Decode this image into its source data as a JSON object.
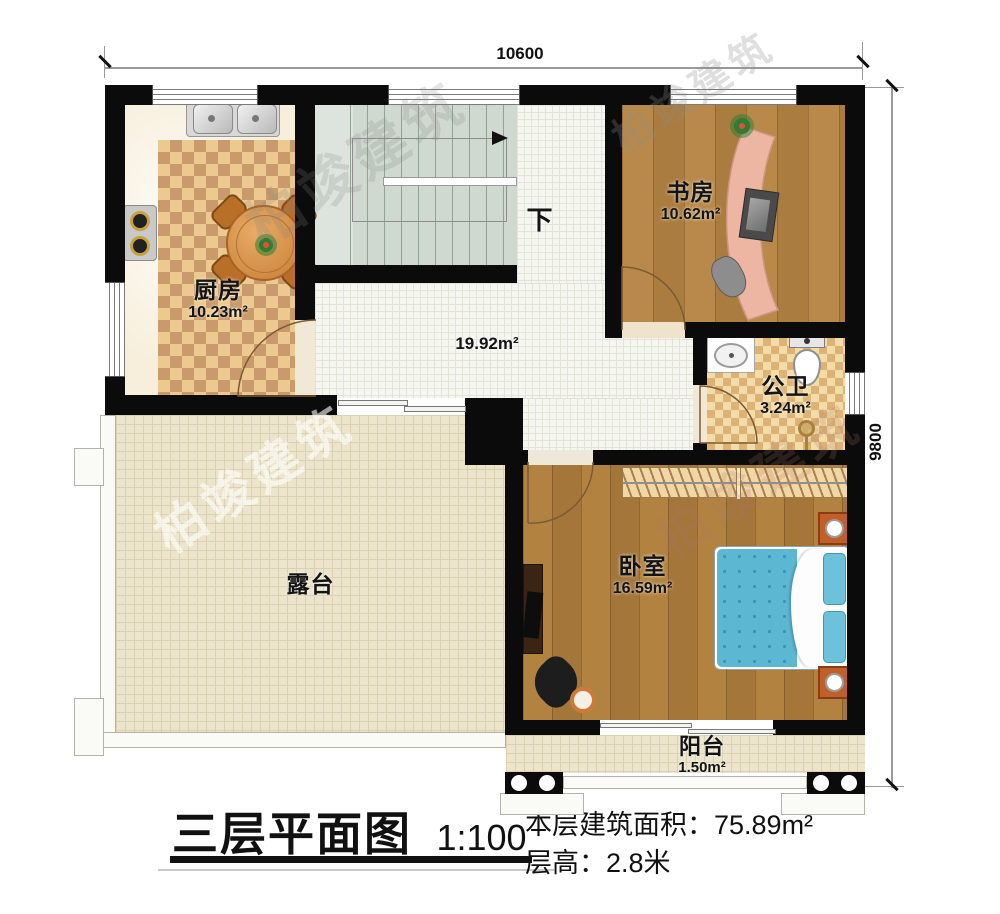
{
  "dimensions": {
    "top": "10600",
    "right": "9800"
  },
  "rooms": {
    "kitchen": {
      "name": "厨房",
      "area": "10.23m²"
    },
    "study": {
      "name": "书房",
      "area": "10.62m²"
    },
    "bathroom": {
      "name": "公卫",
      "area": "3.24m²"
    },
    "bedroom": {
      "name": "卧室",
      "area": "16.59m²"
    },
    "hallway": {
      "area": "19.92m²"
    },
    "terrace": {
      "name": "露台"
    },
    "balcony": {
      "name": "阳台",
      "area": "1.50m²"
    }
  },
  "stairs": {
    "down": "下"
  },
  "title_block": {
    "title": "三层平面图",
    "scale": "1:100",
    "area_label": "本层建筑面积：",
    "area_value": "75.89m²",
    "height_label": "层高：",
    "height_value": "2.8米"
  },
  "watermark": {
    "text": "柏竣建筑"
  },
  "colors": {
    "wall": "#0b0b0b",
    "wood_floor": "#b5873f",
    "bed_blue": "#5bb7d2",
    "checker_dark": "#c89a6c",
    "checker_light": "#ecc98e",
    "outdoor_tile": "#ece5cb"
  }
}
